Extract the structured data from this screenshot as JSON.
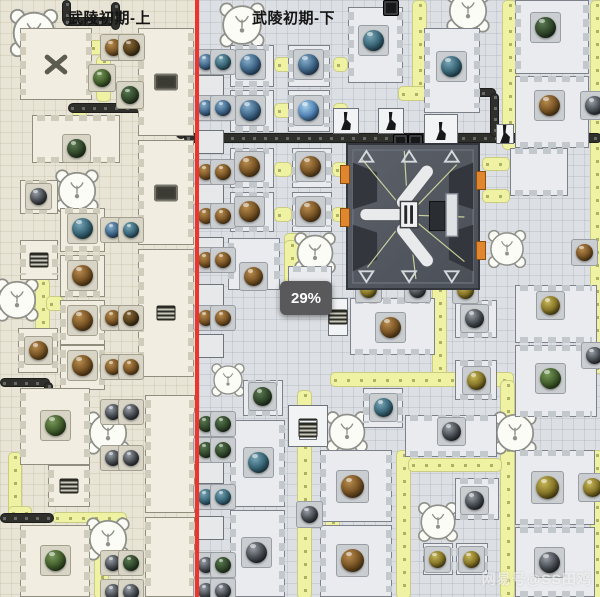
{
  "header": {
    "left_title": "武陵初期-上",
    "right_title": "武陵初期-下"
  },
  "progress_badge": "29%",
  "watermark": "网易号@SS田鸡",
  "colors": {
    "left_bg": "#e9e5d6",
    "right_bg": "#dce0e4",
    "divider_red": "#ee352b",
    "belt_yellow": "#eff2a3",
    "belt_dark": "#2f2f2c",
    "badge_bg": "#59595b",
    "machine_body": "#4a4f57",
    "machine_port_orange": "#e0862f"
  },
  "scene": {
    "belts_yellow": [
      [
        88,
        40,
        22,
        13
      ],
      [
        96,
        56,
        13,
        44
      ],
      [
        72,
        106,
        13,
        44
      ],
      [
        35,
        278,
        13,
        58
      ],
      [
        46,
        296,
        16,
        13
      ],
      [
        8,
        452,
        12,
        62
      ],
      [
        8,
        506,
        22,
        12
      ],
      [
        52,
        512,
        73,
        9
      ],
      [
        94,
        533,
        13,
        64
      ],
      [
        274,
        57,
        16,
        13
      ],
      [
        274,
        103,
        16,
        13
      ],
      [
        333,
        57,
        13,
        13
      ],
      [
        333,
        103,
        13,
        13
      ],
      [
        274,
        162,
        16,
        13
      ],
      [
        274,
        207,
        16,
        13
      ],
      [
        332,
        162,
        14,
        13
      ],
      [
        332,
        207,
        14,
        13
      ],
      [
        412,
        0,
        13,
        90
      ],
      [
        398,
        86,
        28,
        13
      ],
      [
        502,
        0,
        13,
        148
      ],
      [
        590,
        0,
        12,
        372
      ],
      [
        284,
        233,
        22,
        13
      ],
      [
        284,
        240,
        13,
        42
      ],
      [
        432,
        285,
        13,
        90
      ],
      [
        330,
        372,
        182,
        13
      ],
      [
        500,
        380,
        13,
        217
      ],
      [
        297,
        390,
        13,
        207
      ],
      [
        325,
        478,
        13,
        119
      ],
      [
        396,
        450,
        13,
        147
      ],
      [
        408,
        458,
        92,
        12
      ],
      [
        453,
        430,
        48,
        12
      ],
      [
        590,
        450,
        12,
        147
      ],
      [
        482,
        157,
        26,
        12
      ],
      [
        482,
        189,
        26,
        12
      ]
    ],
    "belts_dark": [
      [
        62,
        0,
        7,
        22
      ],
      [
        63,
        17,
        55,
        7
      ],
      [
        111,
        2,
        7,
        26
      ],
      [
        68,
        103,
        110,
        8
      ],
      [
        176,
        103,
        8,
        34
      ],
      [
        0,
        378,
        48,
        7
      ],
      [
        44,
        382,
        7,
        14
      ],
      [
        0,
        513,
        52,
        8
      ],
      [
        184,
        133,
        416,
        8
      ],
      [
        424,
        88,
        70,
        7
      ],
      [
        490,
        93,
        7,
        42
      ]
    ],
    "buildings_left": [
      [
        20,
        28,
        72,
        72,
        "fan"
      ],
      [
        138,
        28,
        56,
        108,
        "device"
      ],
      [
        32,
        115,
        88,
        48
      ],
      [
        20,
        180,
        38,
        34
      ],
      [
        60,
        208,
        45,
        44
      ],
      [
        20,
        240,
        38,
        40,
        "grille"
      ],
      [
        60,
        255,
        45,
        42
      ],
      [
        138,
        140,
        56,
        105,
        "device"
      ],
      [
        60,
        300,
        45,
        45
      ],
      [
        18,
        328,
        40,
        45
      ],
      [
        60,
        345,
        45,
        45
      ],
      [
        138,
        249,
        56,
        128,
        "grille"
      ],
      [
        20,
        388,
        70,
        77
      ],
      [
        48,
        465,
        42,
        42,
        "grille"
      ],
      [
        145,
        395,
        50,
        118
      ],
      [
        20,
        525,
        70,
        72
      ],
      [
        145,
        517,
        50,
        80
      ]
    ],
    "buildings_right": [
      [
        230,
        45,
        44,
        42
      ],
      [
        230,
        90,
        44,
        42
      ],
      [
        288,
        45,
        42,
        42
      ],
      [
        288,
        90,
        42,
        42
      ],
      [
        230,
        148,
        44,
        40
      ],
      [
        230,
        192,
        44,
        40
      ],
      [
        292,
        148,
        40,
        40
      ],
      [
        292,
        192,
        40,
        40
      ],
      [
        228,
        238,
        52,
        52
      ],
      [
        288,
        266,
        44,
        26
      ],
      [
        348,
        7,
        55,
        76
      ],
      [
        424,
        28,
        56,
        85
      ],
      [
        515,
        0,
        74,
        74
      ],
      [
        515,
        76,
        74,
        72
      ],
      [
        510,
        148,
        58,
        48
      ],
      [
        350,
        298,
        85,
        57
      ],
      [
        455,
        300,
        42,
        38
      ],
      [
        455,
        360,
        42,
        40
      ],
      [
        515,
        285,
        82,
        58
      ],
      [
        515,
        345,
        82,
        72
      ],
      [
        243,
        380,
        40,
        36
      ],
      [
        230,
        420,
        55,
        87
      ],
      [
        230,
        510,
        55,
        87
      ],
      [
        363,
        388,
        40,
        40
      ],
      [
        405,
        415,
        92,
        42
      ],
      [
        320,
        450,
        72,
        72
      ],
      [
        320,
        525,
        72,
        72
      ],
      [
        455,
        478,
        44,
        42
      ],
      [
        423,
        543,
        30,
        32
      ],
      [
        456,
        543,
        32,
        32
      ],
      [
        515,
        450,
        80,
        75
      ],
      [
        515,
        527,
        80,
        70
      ]
    ],
    "boxes": [
      [
        333,
        108,
        26,
        26,
        "robot"
      ],
      [
        378,
        108,
        26,
        26,
        "robot"
      ],
      [
        424,
        114,
        34,
        34,
        "robot"
      ],
      [
        496,
        124,
        18,
        20,
        "robot"
      ],
      [
        288,
        405,
        40,
        42,
        "grille"
      ],
      [
        328,
        298,
        20,
        38,
        "grille"
      ],
      [
        299,
        420,
        18,
        20,
        "grille"
      ],
      [
        198,
        75,
        26,
        22
      ],
      [
        198,
        130,
        26,
        24
      ],
      [
        198,
        184,
        26,
        22
      ],
      [
        198,
        237,
        26,
        24
      ],
      [
        198,
        284,
        26,
        22
      ],
      [
        198,
        334,
        26,
        24
      ],
      [
        198,
        462,
        26,
        22
      ],
      [
        198,
        516,
        26,
        24
      ]
    ],
    "dark_items": [
      [
        393,
        134,
        13,
        13
      ],
      [
        408,
        134,
        13,
        13
      ],
      [
        383,
        0,
        14,
        14
      ]
    ],
    "spheres": [
      [
        76,
        148,
        "dgreen",
        20
      ],
      [
        38,
        196,
        "dark",
        18
      ],
      [
        82,
        228,
        "teal",
        22
      ],
      [
        82,
        275,
        "brown",
        22
      ],
      [
        82,
        320,
        "brown",
        22
      ],
      [
        38,
        350,
        "brown",
        20
      ],
      [
        82,
        365,
        "brown",
        22
      ],
      [
        55,
        425,
        "green",
        22
      ],
      [
        55,
        560,
        "green",
        22
      ],
      [
        113,
        47,
        "brown",
        18
      ],
      [
        131,
        47,
        "dbrown",
        18
      ],
      [
        102,
        78,
        "green",
        19
      ],
      [
        130,
        95,
        "dgreen",
        19
      ],
      [
        113,
        230,
        "blue",
        17
      ],
      [
        131,
        230,
        "teal",
        17
      ],
      [
        113,
        318,
        "brown",
        17
      ],
      [
        131,
        318,
        "dbrown",
        17
      ],
      [
        113,
        367,
        "brown",
        17
      ],
      [
        131,
        367,
        "brown",
        17
      ],
      [
        113,
        412,
        "dark",
        17
      ],
      [
        131,
        412,
        "dark",
        17
      ],
      [
        113,
        458,
        "dark",
        17
      ],
      [
        131,
        458,
        "dark",
        17
      ],
      [
        113,
        563,
        "dark",
        17
      ],
      [
        131,
        563,
        "dgreen",
        17
      ],
      [
        113,
        592,
        "dark",
        17
      ],
      [
        131,
        592,
        "dark",
        17
      ],
      [
        206,
        62,
        "blue",
        17
      ],
      [
        223,
        62,
        "teal",
        17
      ],
      [
        206,
        108,
        "blue",
        17
      ],
      [
        223,
        108,
        "blue",
        17
      ],
      [
        206,
        172,
        "brown",
        17
      ],
      [
        223,
        172,
        "brown",
        17
      ],
      [
        206,
        216,
        "brown",
        17
      ],
      [
        223,
        216,
        "brown",
        17
      ],
      [
        206,
        260,
        "brown",
        17
      ],
      [
        223,
        260,
        "brown",
        17
      ],
      [
        206,
        318,
        "brown",
        17
      ],
      [
        223,
        318,
        "brown",
        17
      ],
      [
        206,
        424,
        "dgreen",
        17
      ],
      [
        223,
        424,
        "dgreen",
        17
      ],
      [
        206,
        450,
        "dgreen",
        17
      ],
      [
        223,
        450,
        "dgreen",
        17
      ],
      [
        206,
        497,
        "teal",
        17
      ],
      [
        223,
        497,
        "teal",
        17
      ],
      [
        206,
        565,
        "dark",
        17
      ],
      [
        223,
        565,
        "dgreen",
        17
      ],
      [
        206,
        591,
        "dark",
        17
      ],
      [
        223,
        591,
        "dark",
        17
      ],
      [
        250,
        64,
        "blue",
        22
      ],
      [
        250,
        110,
        "blue",
        22
      ],
      [
        249,
        166,
        "brown",
        22
      ],
      [
        249,
        211,
        "brown",
        22
      ],
      [
        253,
        276,
        "brown",
        20
      ],
      [
        262,
        396,
        "dgreen",
        20
      ],
      [
        258,
        462,
        "teal",
        22
      ],
      [
        256,
        552,
        "dark",
        22
      ],
      [
        308,
        64,
        "blue",
        22
      ],
      [
        308,
        110,
        "bblue",
        22
      ],
      [
        310,
        166,
        "brown",
        22
      ],
      [
        310,
        211,
        "brown",
        22
      ],
      [
        373,
        40,
        "teal",
        22
      ],
      [
        451,
        66,
        "teal",
        22
      ],
      [
        545,
        27,
        "dgreen",
        22
      ],
      [
        549,
        105,
        "brown",
        22
      ],
      [
        594,
        105,
        "dark",
        20
      ],
      [
        390,
        327,
        "brown",
        22
      ],
      [
        474,
        318,
        "dark",
        20
      ],
      [
        476,
        380,
        "olive",
        20
      ],
      [
        550,
        305,
        "olive",
        20
      ],
      [
        550,
        378,
        "green",
        22
      ],
      [
        594,
        355,
        "dark",
        18
      ],
      [
        584,
        252,
        "brown",
        18
      ],
      [
        451,
        431,
        "dark",
        20
      ],
      [
        352,
        486,
        "brown",
        24
      ],
      [
        352,
        560,
        "brown",
        24
      ],
      [
        474,
        500,
        "dark",
        20
      ],
      [
        437,
        559,
        "olive",
        18
      ],
      [
        471,
        559,
        "olive",
        18
      ],
      [
        547,
        487,
        "olive",
        24
      ],
      [
        549,
        562,
        "dark",
        22
      ],
      [
        592,
        487,
        "olive",
        20
      ],
      [
        383,
        407,
        "teal",
        20
      ],
      [
        309,
        514,
        "dark",
        18
      ],
      [
        368,
        289,
        "olive",
        18
      ],
      [
        417,
        289,
        "dark",
        18
      ],
      [
        465,
        290,
        "olive",
        18
      ]
    ],
    "cats": [
      [
        34,
        33,
        58
      ],
      [
        77,
        191,
        52
      ],
      [
        17,
        300,
        52
      ],
      [
        108,
        433,
        52
      ],
      [
        108,
        539,
        52
      ],
      [
        242,
        25,
        54
      ],
      [
        468,
        11,
        52
      ],
      [
        315,
        253,
        50
      ],
      [
        507,
        249,
        46
      ],
      [
        228,
        380,
        40
      ],
      [
        347,
        432,
        50
      ],
      [
        515,
        433,
        52
      ],
      [
        438,
        522,
        48
      ]
    ]
  }
}
